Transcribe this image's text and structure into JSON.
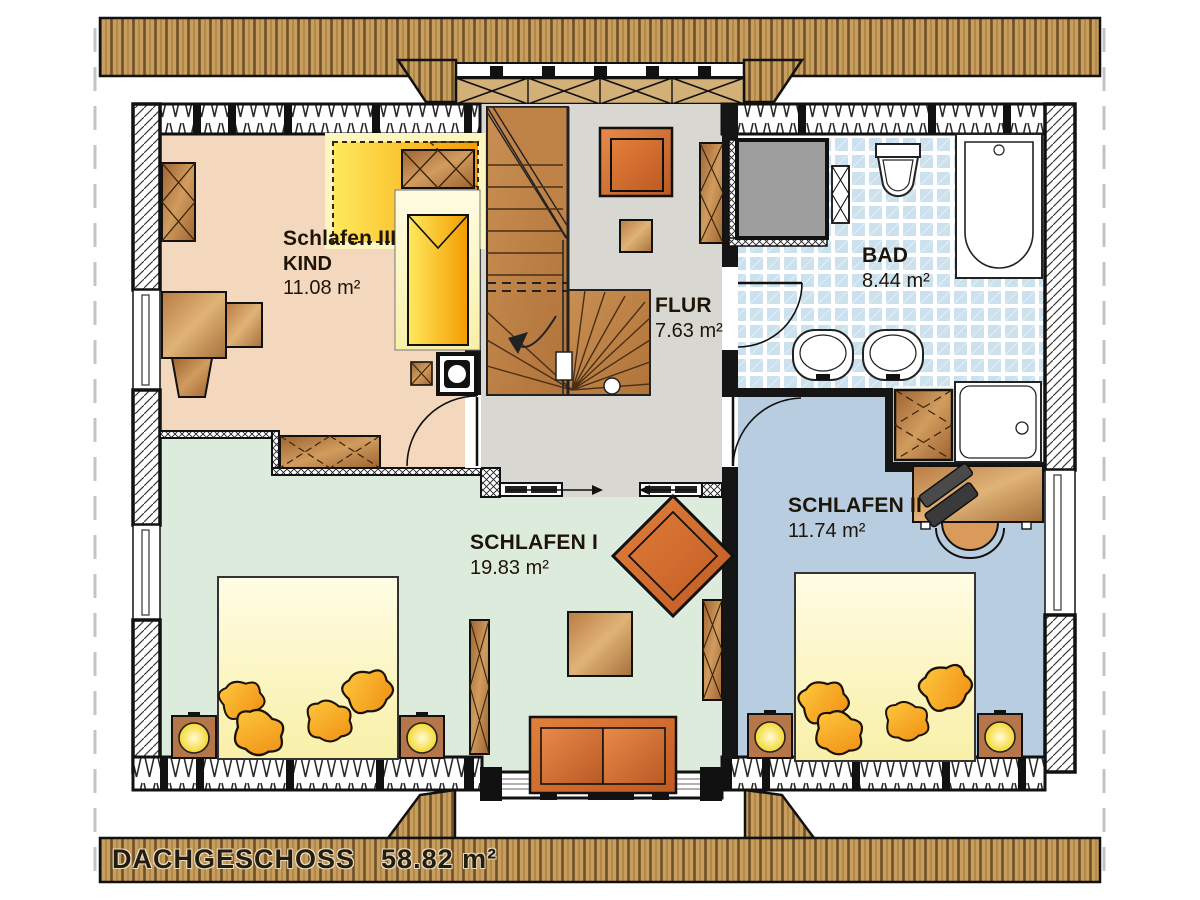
{
  "title_bar": {
    "label": "DACHGESCHOSS",
    "area": "58.82 m²"
  },
  "rooms": {
    "schlafen3": {
      "name": "Schlafen III",
      "subtitle": "KIND",
      "area": "11.08 m²"
    },
    "flur": {
      "name": "FLUR",
      "area": "7.63 m²"
    },
    "bad": {
      "name": "BAD",
      "area": "8.44 m²"
    },
    "schlafen1": {
      "name": "SCHLAFEN I",
      "area": "19.83 m²"
    },
    "schlafen2": {
      "name": "SCHLAFEN II",
      "area": "11.74 m²"
    }
  },
  "colors": {
    "roof_wood": "#c79e5e",
    "floor_schlafen3": "#f3d8bd",
    "floor_flur": "#d9d7d1",
    "floor_bad": "#d4e7f1",
    "floor_schlafen1": "#dcebdb",
    "floor_schlafen2": "#b9cde1",
    "furniture_orange": "#d2691e",
    "bedding_yellow": "#ffd43a",
    "wall_black": "#151515"
  }
}
